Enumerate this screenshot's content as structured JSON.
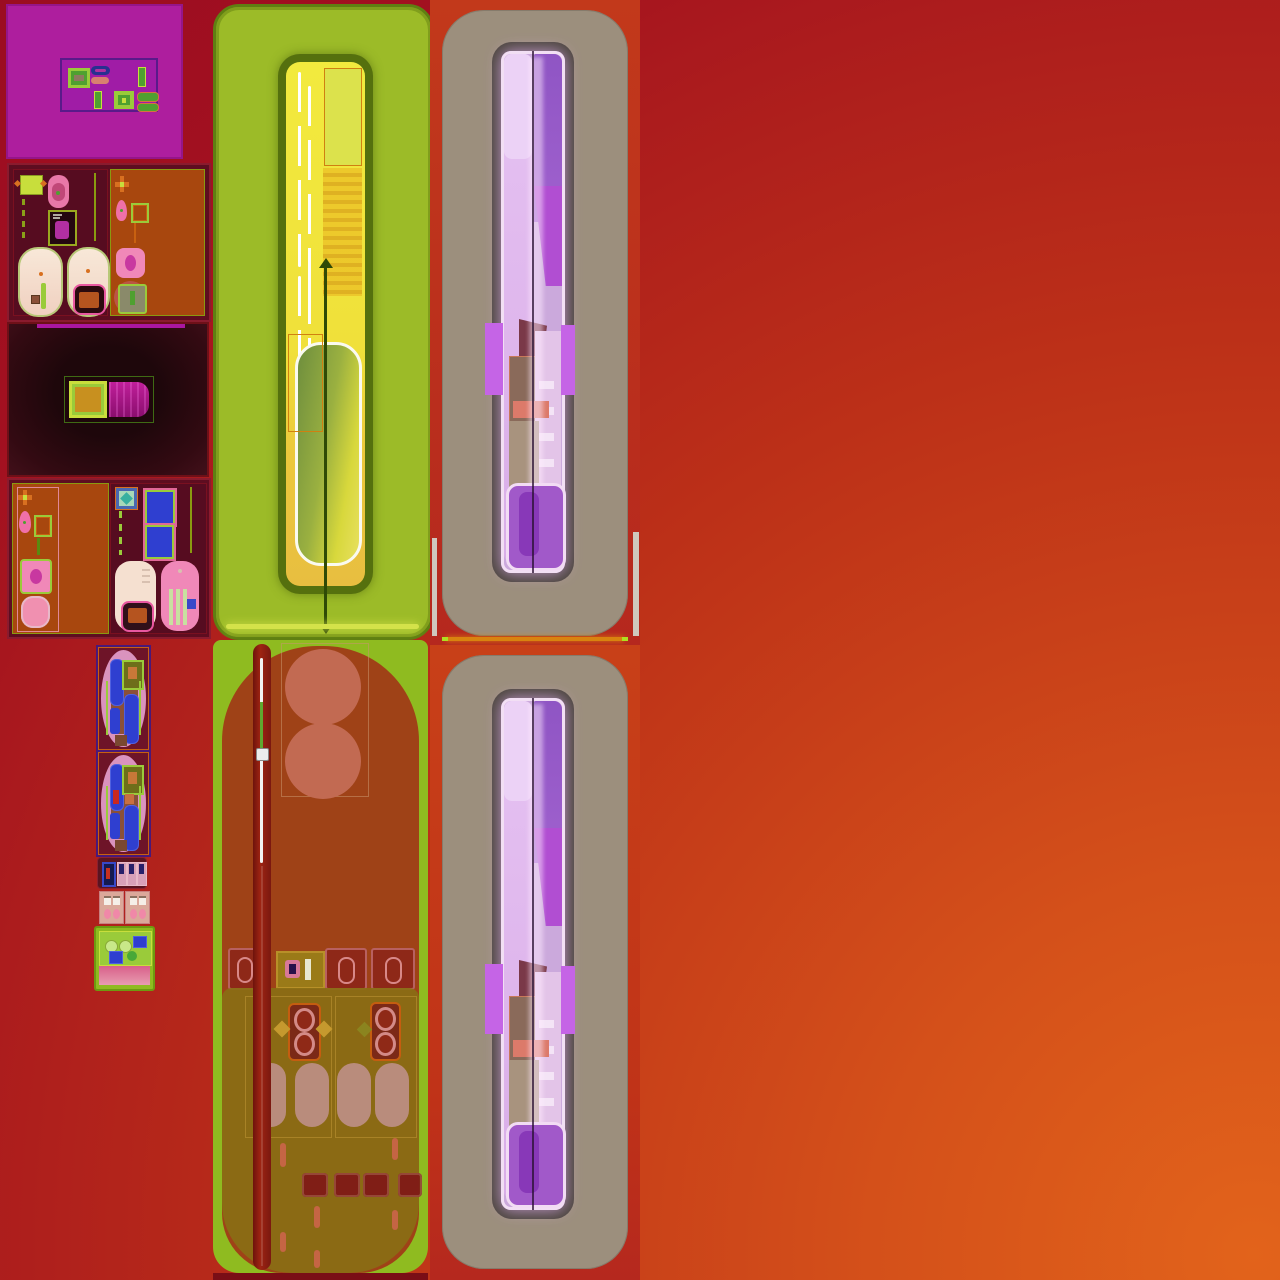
{
  "meta": {
    "description": "Abstract sprite-atlas style composite of blended UI panel fragments on a crimson-to-orange gradient",
    "visible_text": "none"
  },
  "colors": {
    "bg-red": "#A21020",
    "bg-orange": "#E2631B",
    "magenta-panel": "#AE1E9E",
    "violet-box": "#A01CA6",
    "lime": "#9ACB3A",
    "lime-bright": "#C8DE3C",
    "green-widget": "#4FA030",
    "navy-pill": "#283090",
    "salmon-pill": "#D88070",
    "orange-sec": "#A8470E",
    "pink-capsule": "#F2DECE",
    "pink-bright": "#F088B8",
    "magenta-toggle": "#B5188F",
    "toggle-core": "#C8901F",
    "green-panel": "#9CBB28",
    "yellow-bar": "#F0E03A",
    "yellow-deep": "#E8BE40",
    "olive-frame": "#55700E",
    "tan": "#9C8F7D",
    "darkframe": "#4C463E",
    "red-frame": "#B5281E",
    "lav-glow": "#CBA9DC",
    "purple-seg": "#8F55C4",
    "magenta-seg": "#B14ED2",
    "wing-violet": "#C564E6",
    "salmon-bar": "#DC7A6A",
    "brown-arch": "#A03A16",
    "salmon-circle": "#C26A52",
    "stick-red": "#9E2412",
    "olive-deck": "#8A6E14",
    "oval-gray": "#BC9284",
    "darksq-red": "#7E1C16",
    "sprite-blue": "#2F3FD0",
    "sprite-pink": "#DA93BE",
    "glow-line-green": "#D4E24A",
    "glow-line-orange": "#D9830F"
  },
  "panels": [
    {
      "name": "magenta-widget-panel"
    },
    {
      "name": "appliance-sprite-panel-1"
    },
    {
      "name": "dark-toggle-panel"
    },
    {
      "name": "appliance-sprite-panel-2"
    },
    {
      "name": "small-sprite-column"
    },
    {
      "name": "lime-slider-panel"
    },
    {
      "name": "brown-control-deck"
    },
    {
      "name": "tan-violet-bar-panel-top"
    },
    {
      "name": "tan-violet-bar-panel-bottom"
    }
  ]
}
